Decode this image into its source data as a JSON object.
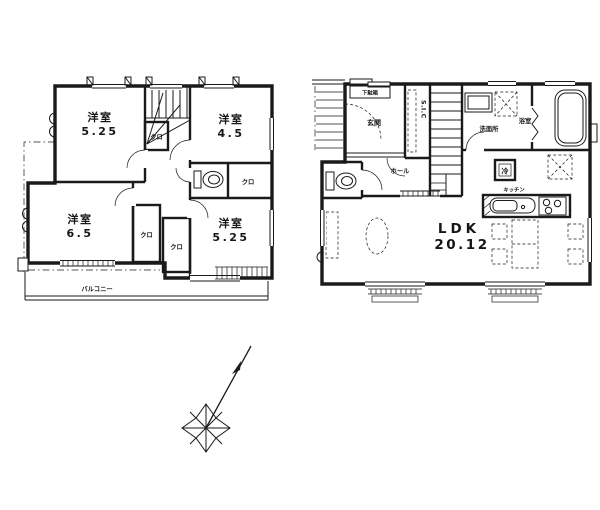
{
  "colors": {
    "ink": "#1a1a1a",
    "paper": "#ffffff"
  },
  "floor2": {
    "bedroom_a_name": "洋室",
    "bedroom_a_size": "5.25",
    "bedroom_b_name": "洋室",
    "bedroom_b_size": "4.5",
    "bedroom_c_name": "洋室",
    "bedroom_c_size": "6.5",
    "bedroom_d_name": "洋室",
    "bedroom_d_size": "5.25",
    "closet_a": "クロ",
    "closet_b": "クロ",
    "closet_c": "クロ",
    "closet_d": "クロ",
    "balcony": "バルコニー"
  },
  "floor1": {
    "entrance": "玄関",
    "shoe_cabinet": "下駄箱",
    "shoe_closet": "S.I.C",
    "washroom": "洗面所",
    "bathroom": "浴室",
    "hall": "ホール",
    "ldk_label": "LDK",
    "ldk_size": "20.12",
    "kitchen": "キッチン",
    "refrigerator": "冷"
  }
}
